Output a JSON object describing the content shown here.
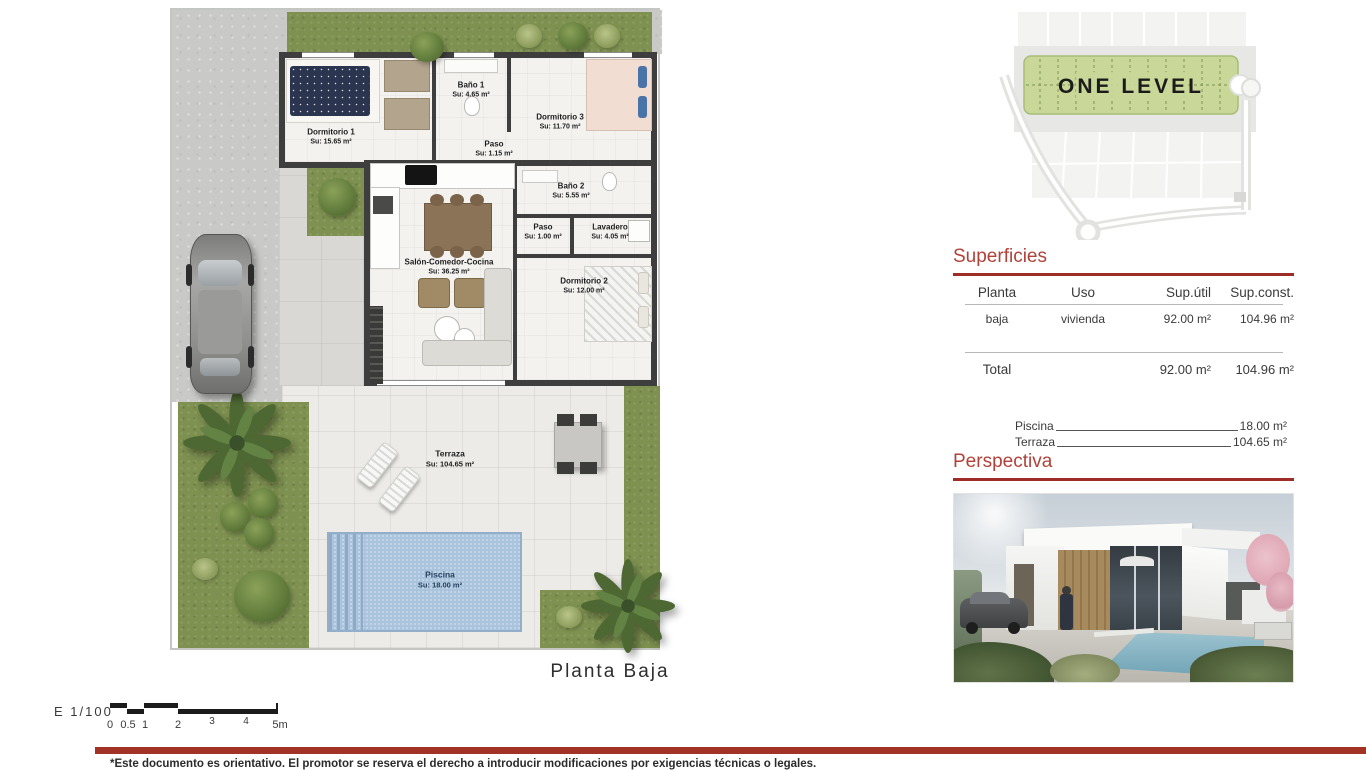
{
  "page": {
    "plan_caption": "Planta Baja",
    "footer_note": "*Este documento es orientativo. El promotor se reserva el derecho a introducir modificaciones por exigencias técnicas o legales."
  },
  "scale": {
    "label": "E 1/100",
    "ticks": [
      "0",
      "0.5",
      "1",
      "2",
      "3",
      "4",
      "5m"
    ]
  },
  "site_plan": {
    "label": "ONE LEVEL"
  },
  "floor_plan": {
    "rooms": [
      {
        "name": "Dormitorio 1",
        "area": "Su: 15.65 m²"
      },
      {
        "name": "Baño 1",
        "area": "Su: 4.65 m²"
      },
      {
        "name": "Dormitorio 3",
        "area": "Su: 11.70 m²"
      },
      {
        "name": "Paso",
        "area": "Su: 1.15 m²"
      },
      {
        "name": "Baño 2",
        "area": "Su: 5.55 m²"
      },
      {
        "name": "Paso",
        "area": "Su: 1.00 m²"
      },
      {
        "name": "Lavadero",
        "area": "Su: 4.05 m²"
      },
      {
        "name": "Salón-Comedor-Cocina",
        "area": "Su: 36.25 m²"
      },
      {
        "name": "Dormitorio 2",
        "area": "Su: 12.00 m²"
      },
      {
        "name": "Terraza",
        "area": "Su: 104.65 m²"
      },
      {
        "name": "Piscina",
        "area": "Su: 18.00 m²"
      }
    ]
  },
  "superficies": {
    "title": "Superficies",
    "headers": [
      "Planta",
      "Uso",
      "Sup.útil",
      "Sup.const."
    ],
    "row": {
      "planta": "baja",
      "uso": "vivienda",
      "sup_util": "92.00 m²",
      "sup_const": "104.96 m²"
    },
    "total": {
      "label": "Total",
      "sup_util": "92.00 m²",
      "sup_const": "104.96 m²"
    },
    "extras": [
      {
        "label": "Piscina",
        "value": "18.00 m²"
      },
      {
        "label": "Terraza",
        "value": "104.65 m²"
      }
    ]
  },
  "perspectiva": {
    "title": "Perspectiva"
  },
  "colors": {
    "accent_red": "#a23126",
    "title_red": "#b0423a",
    "grass_green": "#7e9150",
    "band_green": "#c9d899",
    "pool_blue": "#aac4dd",
    "wall_dark": "#3e3e3e"
  }
}
